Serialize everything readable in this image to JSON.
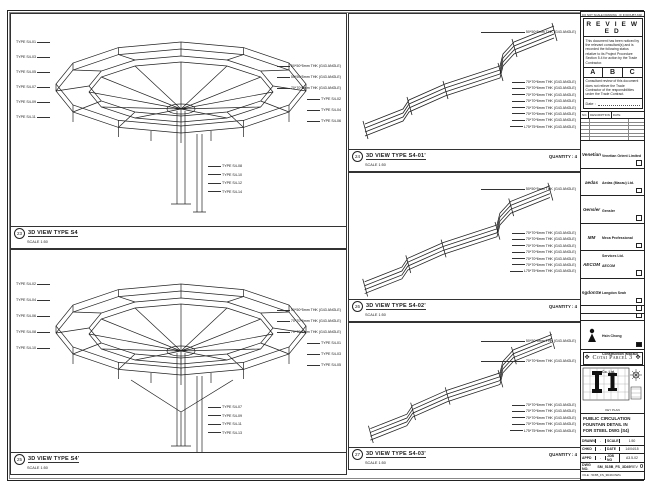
{
  "frame": {
    "top_note": "DO NOT SCALE DRAWING · IF IN DOUBT ASK · ALL DIMENSIONS IN MILLIMETRES"
  },
  "panels": {
    "a": {
      "num": "23",
      "title": "3D VIEW TYPE S4",
      "scale": "SCALE 1:50",
      "left_labels": [
        "TYPE S4-01",
        "TYPE S4-03",
        "TYPE S4-05",
        "TYPE S4-07",
        "TYPE S4-09",
        "TYPE S4-11"
      ],
      "right_labels": [
        "50*50*5mm THK (G43 ANGLE)",
        "50*50*5mm THK (G43 ANGLE)",
        "70*70*6mm THK (G43 ANGLE)",
        "TYPE S4-02",
        "TYPE S4-04",
        "TYPE S4-06"
      ],
      "bottom_labels": [
        "TYPE S4-08",
        "TYPE S4-10",
        "TYPE S4-12",
        "TYPE S4-14"
      ]
    },
    "b": {
      "num": "25",
      "title": "3D VIEW TYPE S4'",
      "scale": "SCALE 1:50",
      "left_labels": [
        "TYPE S4-02",
        "TYPE S4-04",
        "TYPE S4-06",
        "TYPE S4-08",
        "TYPE S4-10"
      ],
      "right_labels": [
        "50*50*5mm THK (G43 ANGLE)",
        "70*70*6mm THK (G43 ANGLE)",
        "70*70*6mm THK (G43 ANGLE)",
        "TYPE S4-01",
        "TYPE S4-03",
        "TYPE S4-05"
      ],
      "bottom_labels": [
        "TYPE S4-07",
        "TYPE S4-09",
        "TYPE S4-11",
        "TYPE S4-13"
      ]
    },
    "r1": {
      "num": "24",
      "title": "3D VIEW TYPE S4-01'",
      "quantity": "QUANTITY : 4",
      "scale": "SCALE 1:50",
      "top_labels": [
        "50*50*5mm THK (G43 ANGLE)"
      ],
      "side_labels": [
        "70*70*6mm THK (G43 ANGLE)",
        "70*70*6mm THK (G43 ANGLE)",
        "70*70*6mm THK (G43 ANGLE)",
        "70*70*6mm THK (G43 ANGLE)",
        "70*70*6mm THK (G43 ANGLE)",
        "70*70*6mm THK (G43 ANGLE)",
        "70*70*6mm THK (G43 ANGLE)",
        "L75*75*6mm THK (G43 ANGLE)"
      ]
    },
    "r2": {
      "num": "26",
      "title": "3D VIEW TYPE S4-02'",
      "quantity": "QUANTITY : 4",
      "scale": "SCALE 1:50",
      "top_labels": [
        "50*50*5mm THK (G43 ANGLE)"
      ],
      "side_labels": [
        "70*70*6mm THK (G43 ANGLE)",
        "70*70*6mm THK (G43 ANGLE)",
        "70*70*6mm THK (G43 ANGLE)",
        "70*70*6mm THK (G43 ANGLE)",
        "70*70*6mm THK (G43 ANGLE)",
        "70*70*6mm THK (G43 ANGLE)",
        "L75*75*6mm THK (G43 ANGLE)"
      ]
    },
    "r3": {
      "num": "27",
      "title": "3D VIEW TYPE S4-03'",
      "quantity": "QUANTITY : 4",
      "scale": "SCALE 1:50",
      "top_labels": [
        "50*50*5mm THK (G43 ANGLE)",
        "70*70*6mm THK (G43 ANGLE)"
      ],
      "side_labels": [
        "70*70*6mm THK (G43 ANGLE)",
        "70*70*6mm THK (G43 ANGLE)",
        "70*70*6mm THK (G43 ANGLE)",
        "70*70*6mm THK (G43 ANGLE)",
        "L75*75*6mm THK (G43 ANGLE)"
      ]
    }
  },
  "stamp": {
    "title": "R E V I E W E D",
    "para1": "This document has been noticed by the relevant consultant(s) and is recorded the following status relative to its Project Procedure Section 5.4 for action by the Trade Contractor.",
    "options": [
      "A",
      "B",
      "C"
    ],
    "para2": "Consultant review of this document does not relieve the Trade Contractor of the responsibilities under the Trade Contract.",
    "date_label": "Date :"
  },
  "revisions": {
    "headers": [
      "NO.",
      "DESCRIPTION",
      "DATE"
    ]
  },
  "companies": [
    {
      "logotext": "Venetian",
      "name": "Venetian Orient Limited"
    },
    {
      "logotext": "aedas",
      "name": "Aedas (Macau) Ltd."
    },
    {
      "logotext": "Gensler",
      "name": "Gensler"
    },
    {
      "logotext": "MM",
      "name": "Meca Professional Services Ltd."
    },
    {
      "logotext": "AECOM",
      "name": "AECOM"
    },
    {
      "logotext": "LangdonSeah",
      "name": "Langdon Seah"
    }
  ],
  "contractor": {
    "name": "Hsin Chong Construction (Macau) Co. Ltd."
  },
  "project": {
    "banner": "Cotai Parcel 3"
  },
  "keyplan": {
    "caption": "KEY PLAN"
  },
  "titleblock": {
    "drawing_title_lines": [
      "PUBLIC CIRCULATION",
      "FOUNTAIN DETAIL IN",
      "FOR STEEL DWG (S4)"
    ],
    "fields": [
      {
        "k": "DRAWN",
        "v": "-",
        "k2": "SCALE",
        "v2": "1:50"
      },
      {
        "k": "CHKD",
        "v": "-",
        "k2": "DATE",
        "v2": "14/04/15"
      },
      {
        "k": "APPD",
        "v": "-",
        "k2": "JOB NO",
        "v2": "A3.5-02"
      }
    ],
    "dwg_label": "DWG NO.",
    "dwg_no": "SM_515B_FS_3D49",
    "rev_label": "REV",
    "rev": "0",
    "file_line": "FILE : 515B_FS_3D49.DWG"
  }
}
